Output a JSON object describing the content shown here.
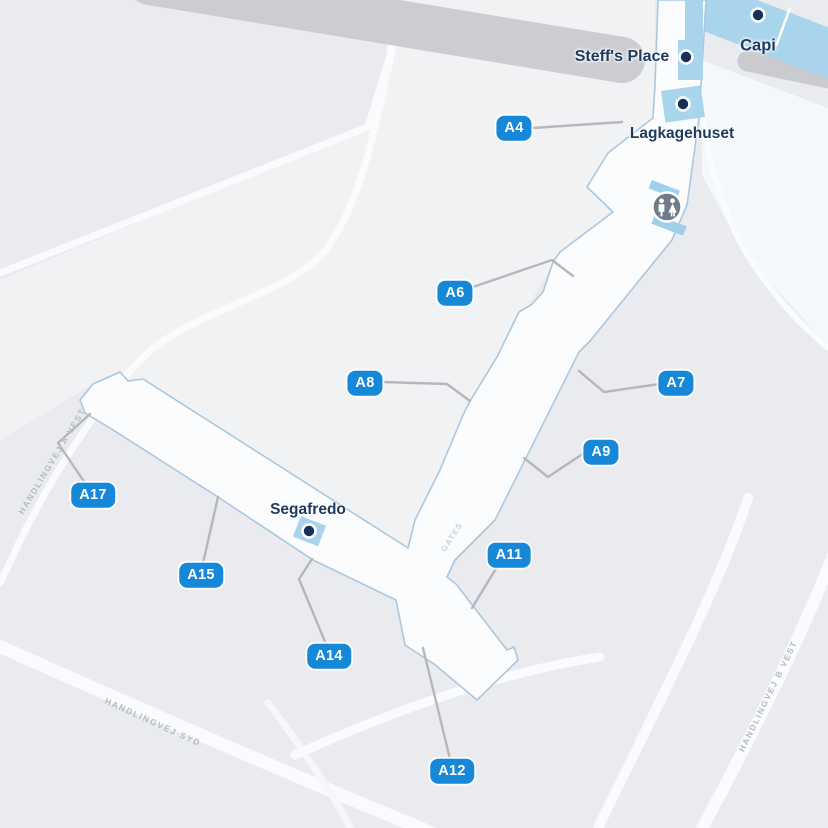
{
  "map": {
    "gates": [
      {
        "label": "A4"
      },
      {
        "label": "A6"
      },
      {
        "label": "A7"
      },
      {
        "label": "A8"
      },
      {
        "label": "A9"
      },
      {
        "label": "A11"
      },
      {
        "label": "A12"
      },
      {
        "label": "A14"
      },
      {
        "label": "A15"
      },
      {
        "label": "A17"
      }
    ],
    "places": [
      {
        "name": "Steff's Place",
        "type": "food"
      },
      {
        "name": "Capi",
        "type": "shop"
      },
      {
        "name": "Lagkagehuset",
        "type": "bakery"
      },
      {
        "name": "Segafredo",
        "type": "cafe"
      }
    ],
    "streets": [
      {
        "name": "HANDLINGVEJ A VEST"
      },
      {
        "name": "HANDLINGVEJ SYD"
      },
      {
        "name": "HANDLINGVEJ B VEST"
      }
    ],
    "corridor_label": "GATES",
    "amenities": [
      {
        "type": "restroom"
      }
    ],
    "colors": {
      "background": "#e9ebee",
      "apron": "#f0f2f4",
      "pier_fill": "#fbfcfe",
      "pier_stroke": "#a9c8e0",
      "shop_fill": "#a8d4ec",
      "gate_badge": "#1787d8",
      "navy_text": "#1e3a5f",
      "poi_dot": "#16305c",
      "road_gray": "#cccdd0",
      "road_white": "#fafbfd",
      "leader_line": "#b5b7ba",
      "restroom_gray": "#6e7b8b"
    }
  }
}
